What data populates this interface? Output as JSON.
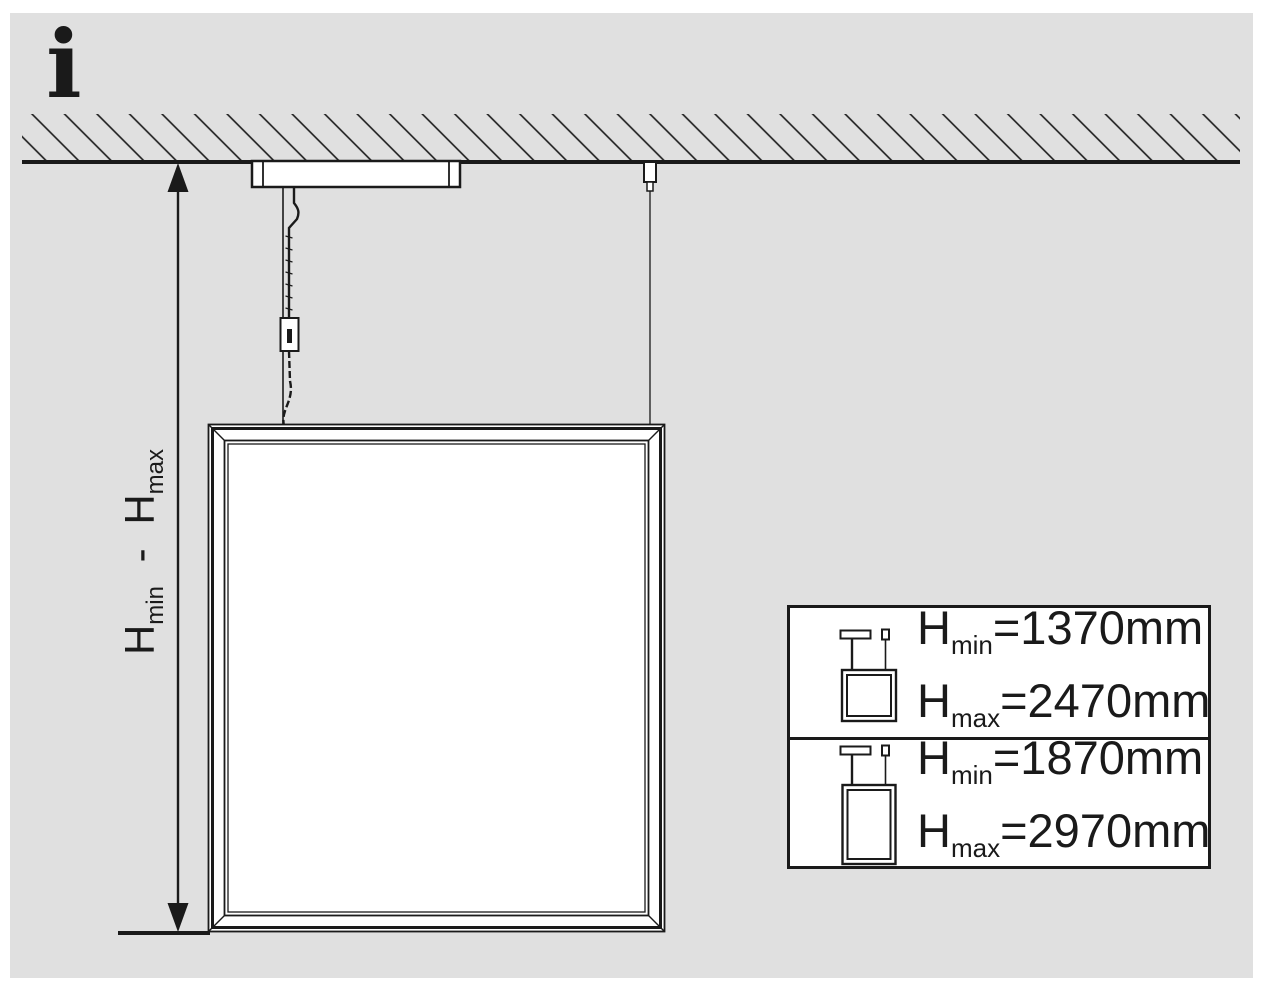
{
  "colors": {
    "background": "#e0e0e0",
    "ink": "#1a1a1a",
    "fill": "#ffffff"
  },
  "info_symbol": "i",
  "dimension_label": {
    "min": {
      "base": "H",
      "sub": "min"
    },
    "separator": "-",
    "max": {
      "base": "H",
      "sub": "max"
    }
  },
  "spec_table": {
    "rows": [
      {
        "panel_icon": "square-panel-suspended-icon",
        "hmin": {
          "base": "H",
          "sub": "min",
          "value": "=1370mm"
        },
        "hmax": {
          "base": "H",
          "sub": "max",
          "value": "=2470mm"
        }
      },
      {
        "panel_icon": "portrait-panel-suspended-icon",
        "hmin": {
          "base": "H",
          "sub": "min",
          "value": "=1870mm"
        },
        "hmax": {
          "base": "H",
          "sub": "max",
          "value": "=2970mm"
        }
      }
    ]
  }
}
